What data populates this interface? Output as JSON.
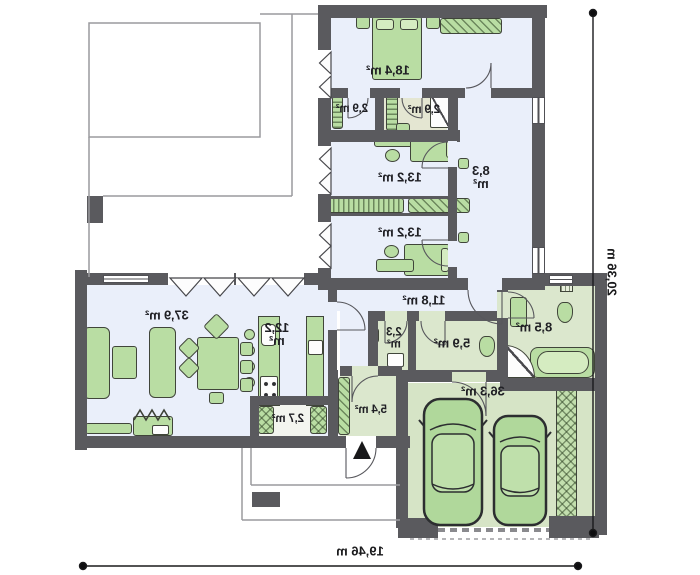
{
  "plan": {
    "rooms": [
      {
        "name": "master-bedroom",
        "area": "18,4 m²"
      },
      {
        "name": "wardrobe-left",
        "area": "2,9 m²"
      },
      {
        "name": "bathroom-ensuite",
        "area": "2,9 m²"
      },
      {
        "name": "bedroom-upper",
        "area": "13,2 m²"
      },
      {
        "name": "corridor",
        "area": "8,3\nm²"
      },
      {
        "name": "bedroom-lower",
        "area": "13,2 m²"
      },
      {
        "name": "hallway",
        "area": "11,8 m²"
      },
      {
        "name": "bathroom-main",
        "area": "8,5 m²"
      },
      {
        "name": "wc",
        "area": "2,3\nm²"
      },
      {
        "name": "bathroom-guest",
        "area": "5,9 m²"
      },
      {
        "name": "living-room",
        "area": "37,9 m²"
      },
      {
        "name": "kitchen",
        "area": "12,2\nm²"
      },
      {
        "name": "pantry",
        "area": "2,7 m²"
      },
      {
        "name": "entry-hall",
        "area": "5,4 m²"
      },
      {
        "name": "garage",
        "area": "36,3 m²"
      }
    ],
    "dimensions": {
      "width": "19,46 m",
      "height": "20,36 m"
    },
    "colors": {
      "wall": "#5a5a5e",
      "floor_light": "#eaeffa",
      "floor_green": "#dbe7cd",
      "floor_garage": "#d6e4c6",
      "floor_beige": "#e4e6d2",
      "furniture": "#b9dda3",
      "text": "#1f1f24"
    }
  }
}
